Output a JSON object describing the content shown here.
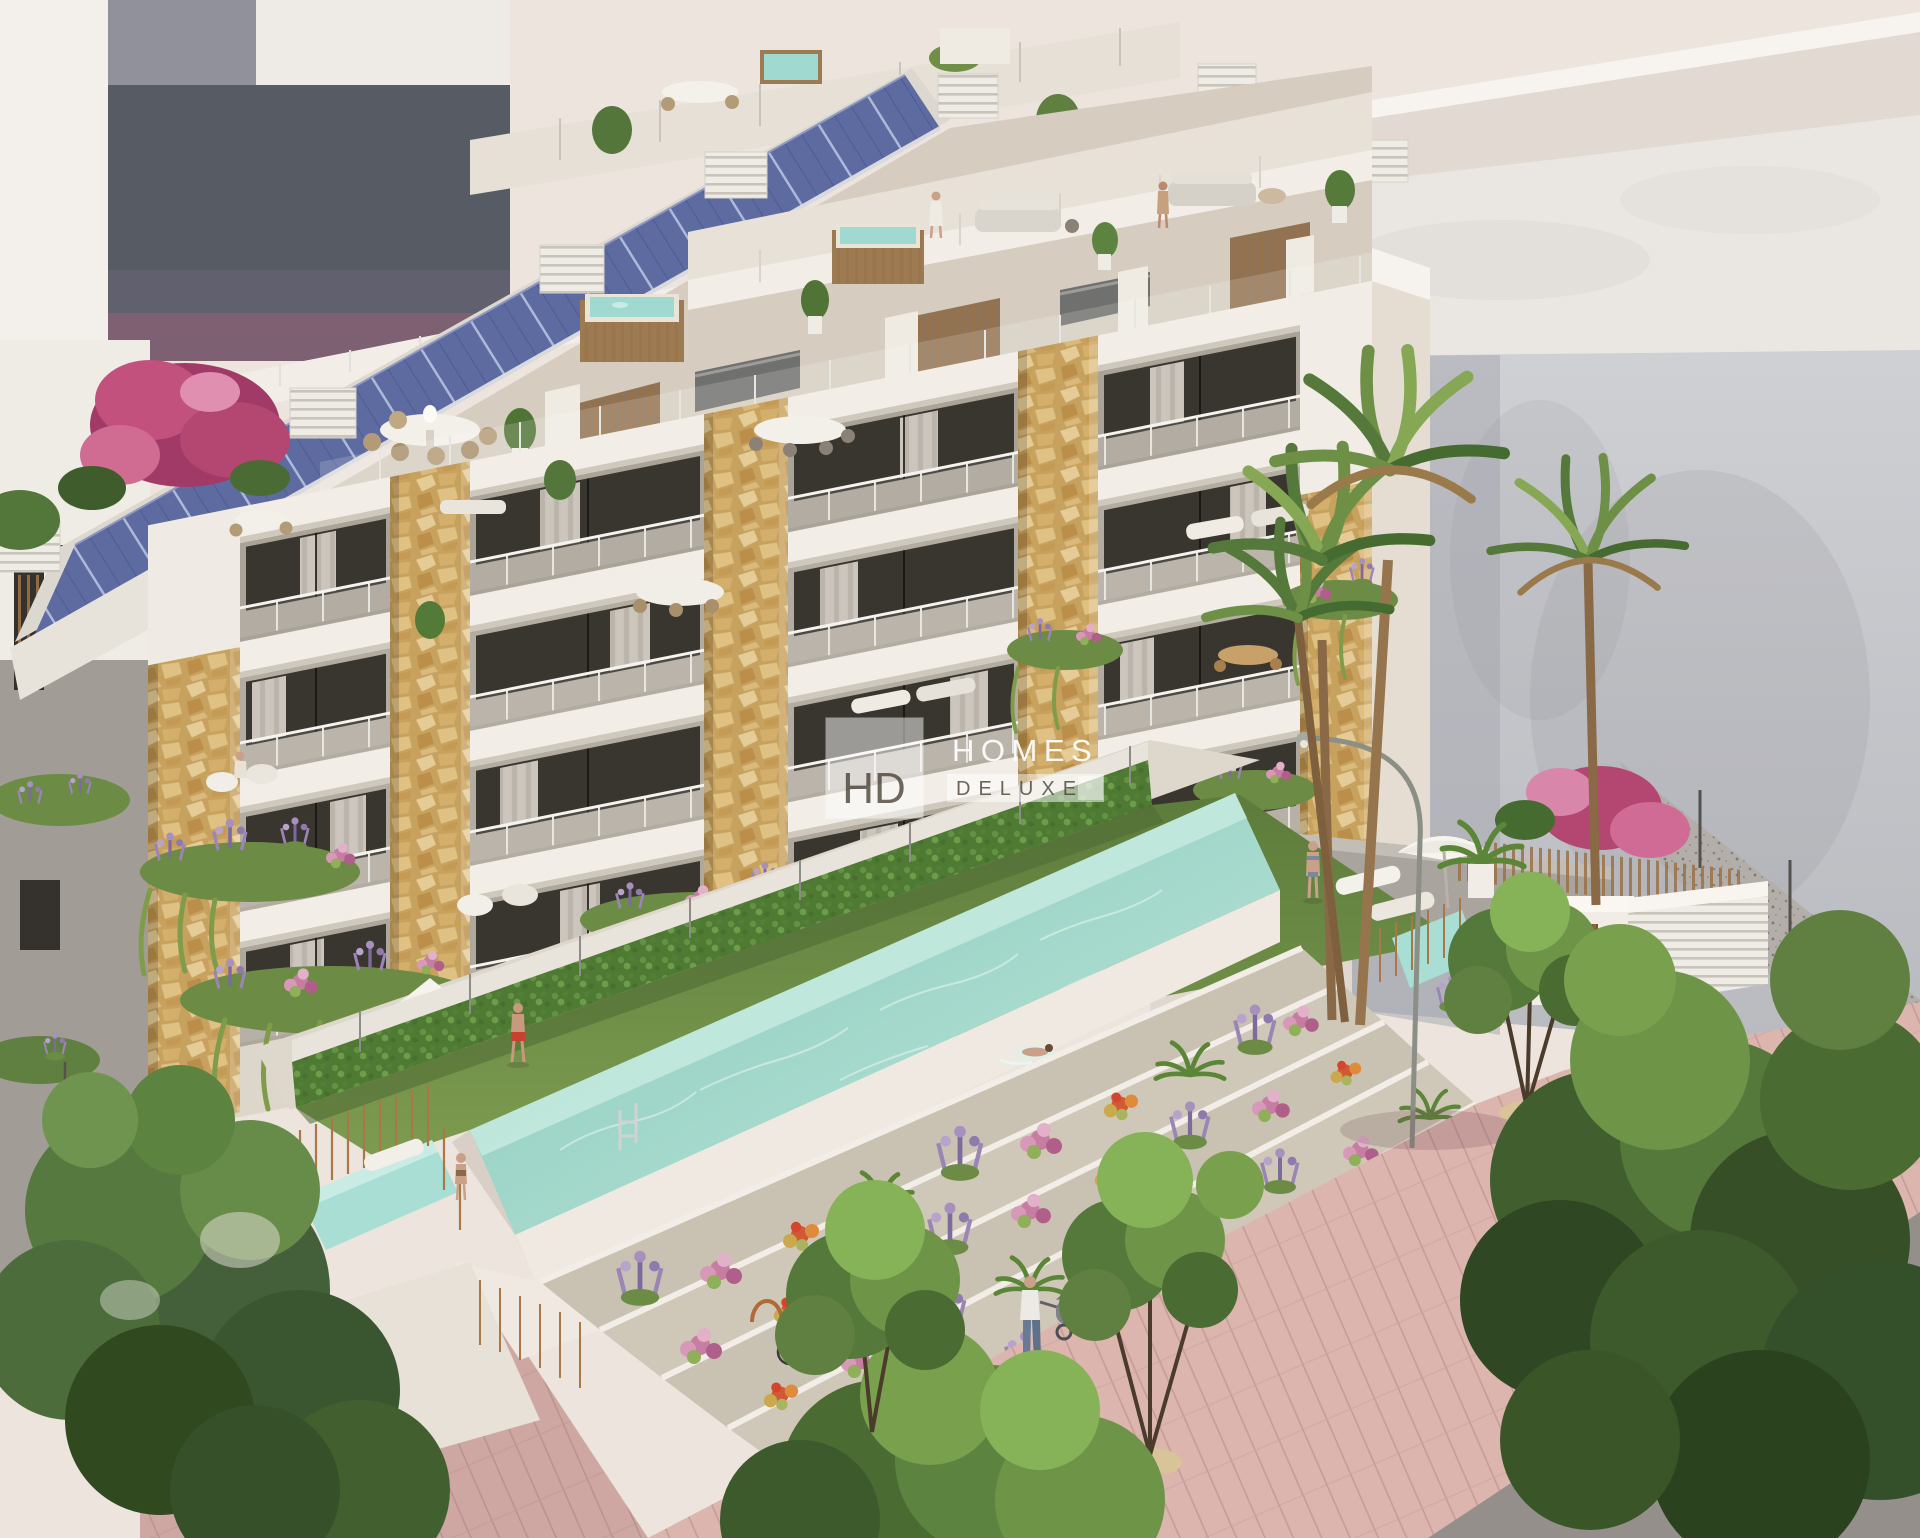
{
  "watermark": {
    "monogram": "HD",
    "title": "HOMES",
    "subtitle": "DELUXE"
  },
  "scene": {
    "description": "Aerial 3D architectural rendering of a modern six-storey apartment building with rooftop solar panels, penthouse terraces with jacuzzis, stone-clad pillars, plant-draped balconies, a long turquoise pool with a swimmer, terraced flower gardens, palm trees, and a pink paved promenade with pedestrians, bicycles and street trees."
  },
  "palette": {
    "sky": "#ece4dd",
    "building_white": "#f2eee7",
    "slab_shadow": "#cfc8bd",
    "stone": "#d9b97c",
    "stone_dark": "#b98f4a",
    "window_glass": "#39352f",
    "curtain": "#d9d3cb",
    "solar_panel": "#5d6ba0",
    "solar_grid": "#b8c0dc",
    "pool_water": "#9fd6c9",
    "pool_deep": "#7fc0b2",
    "jacuzzi_water": "#9fd9d0",
    "lawn": "#74944a",
    "hedge": "#557f36",
    "promenade": "#dcb3ae",
    "foliage_light": "#86b258",
    "foliage_dark": "#3f5d2c",
    "lavender": "#a78fbe",
    "bougainvillea": "#c2517e",
    "wood": "#9c7a52",
    "background_block": "#cbccd0",
    "watermark_panel": "#ffffff",
    "watermark_dark": "#443c2f"
  }
}
